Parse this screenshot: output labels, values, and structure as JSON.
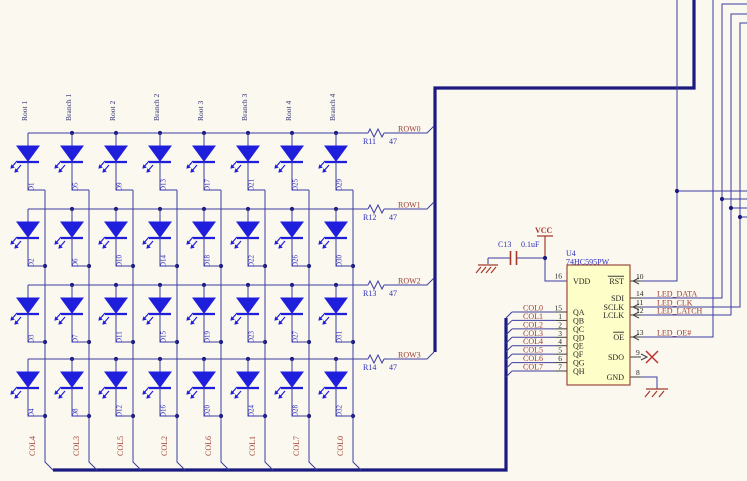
{
  "matrix": {
    "column_headers": [
      "Root 1",
      "Branch 1",
      "Root 2",
      "Branch 2",
      "Root 3",
      "Branch 3",
      "Root 4",
      "Branch 4"
    ],
    "rows": [
      {
        "net": "ROW0",
        "resistor_ref": "R11",
        "resistor_value": "47",
        "leds": [
          "D1",
          "D5",
          "D9",
          "D13",
          "D17",
          "D21",
          "D25",
          "D29"
        ]
      },
      {
        "net": "ROW1",
        "resistor_ref": "R12",
        "resistor_value": "47",
        "leds": [
          "D2",
          "D6",
          "D10",
          "D14",
          "D18",
          "D22",
          "D26",
          "D30"
        ]
      },
      {
        "net": "ROW2",
        "resistor_ref": "R13",
        "resistor_value": "47",
        "leds": [
          "D3",
          "D7",
          "D11",
          "D15",
          "D19",
          "D23",
          "D27",
          "D31"
        ]
      },
      {
        "net": "ROW3",
        "resistor_ref": "R14",
        "resistor_value": "47",
        "leds": [
          "D4",
          "D8",
          "D12",
          "D16",
          "D20",
          "D24",
          "D28",
          "D32"
        ]
      }
    ],
    "column_nets": [
      "COL4",
      "COL3",
      "COL5",
      "COL2",
      "COL6",
      "COL1",
      "COL7",
      "COL0"
    ]
  },
  "capacitor": {
    "ref": "C13",
    "value": "0.1uF"
  },
  "power": {
    "vcc": "VCC"
  },
  "ic": {
    "ref": "U4",
    "part": "74HC595PW",
    "left_pins": [
      {
        "number": "16",
        "name": "VDD",
        "net": ""
      },
      {
        "number": "15",
        "name": "QA",
        "net": "COL0"
      },
      {
        "number": "1",
        "name": "QB",
        "net": "COL1"
      },
      {
        "number": "2",
        "name": "QC",
        "net": "COL2"
      },
      {
        "number": "3",
        "name": "QD",
        "net": "COL3"
      },
      {
        "number": "4",
        "name": "QE",
        "net": "COL4"
      },
      {
        "number": "5",
        "name": "QF",
        "net": "COL5"
      },
      {
        "number": "6",
        "name": "QG",
        "net": "COL6"
      },
      {
        "number": "7",
        "name": "QH",
        "net": "COL7"
      }
    ],
    "right_pins": [
      {
        "number": "10",
        "name": "RST",
        "net": "",
        "overline": true
      },
      {
        "number": "14",
        "name": "SDI",
        "net": "LED_DATA",
        "overline": false
      },
      {
        "number": "11",
        "name": "SCLK",
        "net": "LED_CLK",
        "overline": false
      },
      {
        "number": "12",
        "name": "LCLK",
        "net": "LED_LATCH",
        "overline": false
      },
      {
        "number": "13",
        "name": "OE",
        "net": "LED_OE#",
        "overline": true
      },
      {
        "number": "9",
        "name": "SDO",
        "net": "",
        "overline": false
      },
      {
        "number": "8",
        "name": "GND",
        "net": "",
        "overline": false
      }
    ]
  },
  "colors": {
    "background": "#FAF8EF",
    "wire": "#3D3DA3",
    "bus": "#1A1A80",
    "led_blue": "#1E1EDC",
    "net_label": "#9E3D32",
    "designator": "#3030B8",
    "part_body": "#FEFEC8",
    "part_border": "#9B4A42"
  }
}
